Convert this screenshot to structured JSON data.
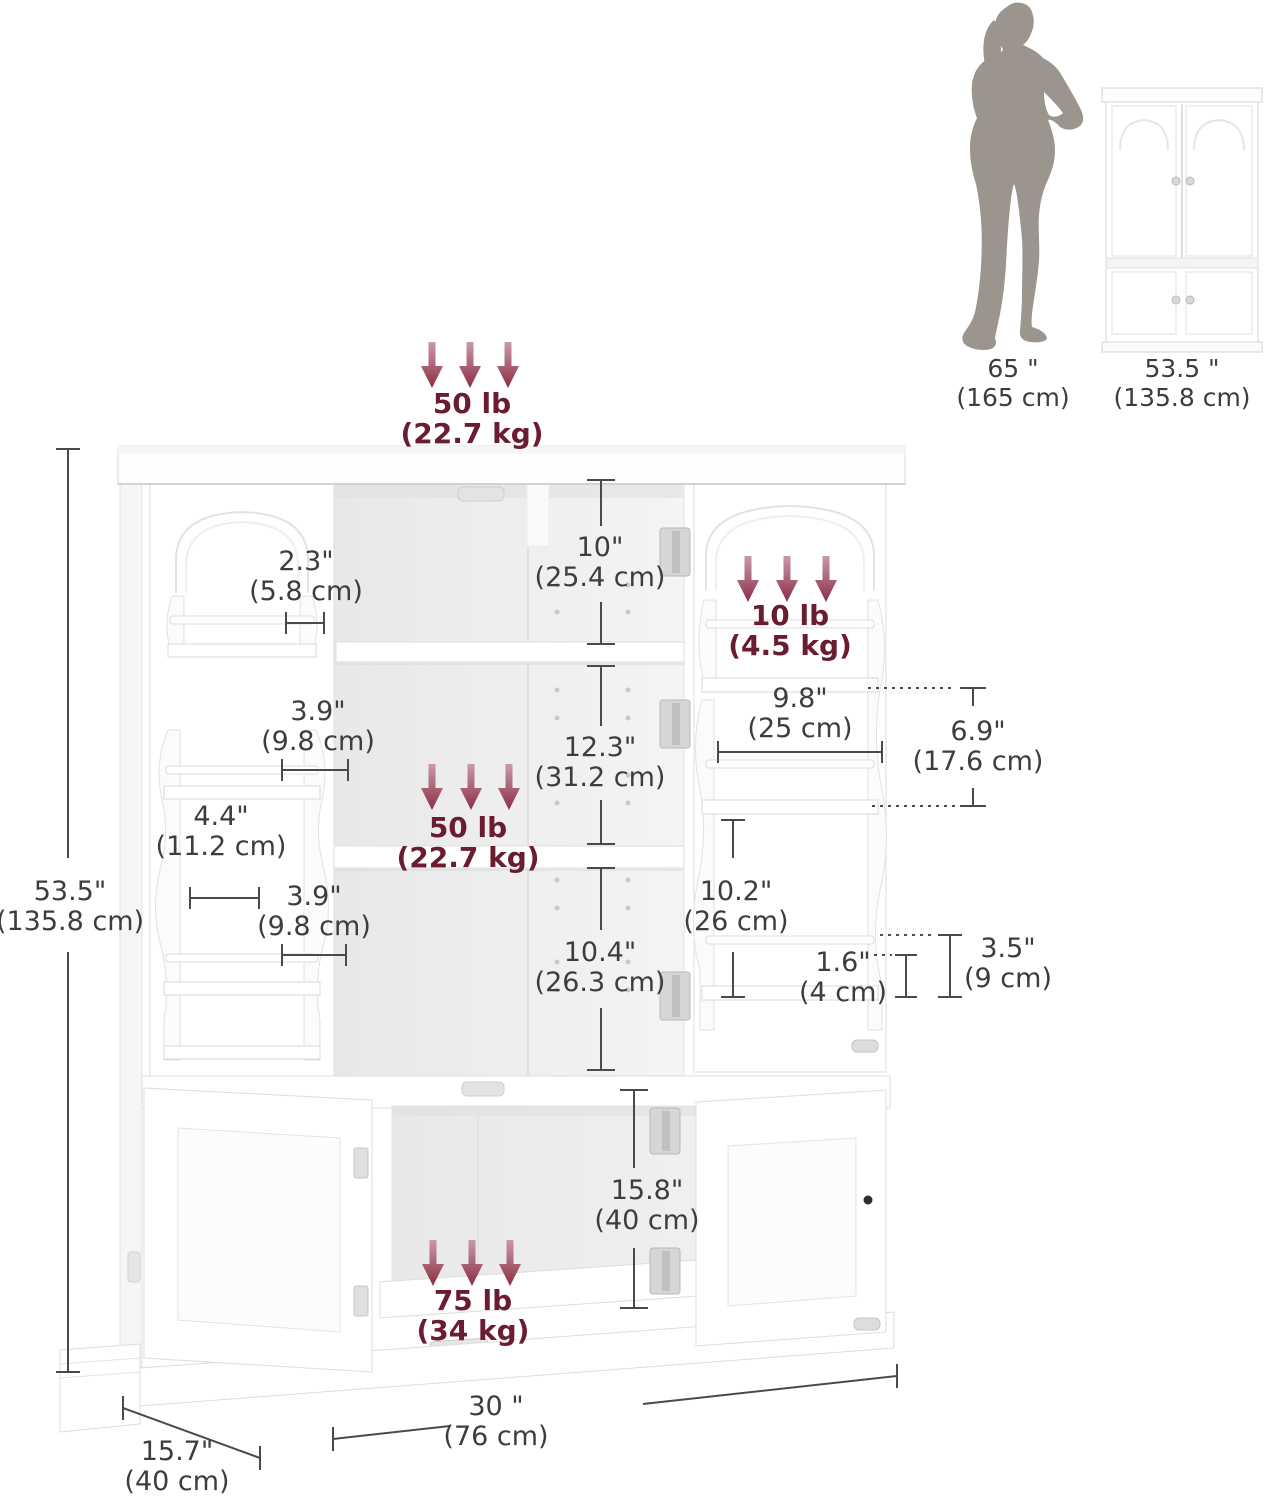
{
  "comparison": {
    "person": {
      "value": "65 \"",
      "metric": "(165 cm)"
    },
    "cabinet": {
      "value": "53.5 \"",
      "metric": "(135.8 cm)"
    }
  },
  "weight_capacities": {
    "top_panel": {
      "value": "50 lb",
      "metric": "(22.7 kg)"
    },
    "door_rack": {
      "value": "10 lb",
      "metric": "(4.5 kg)"
    },
    "middle_shelf": {
      "value": "50 lb",
      "metric": "(22.7 kg)"
    },
    "bottom_compartment": {
      "value": "75 lb",
      "metric": "(34 kg)"
    }
  },
  "dimensions": {
    "overall_height": {
      "value": "53.5\"",
      "metric": "(135.8 cm)"
    },
    "left_rack_top_depth": {
      "value": "2.3\"",
      "metric": "(5.8 cm)"
    },
    "left_rack_upper_gap": {
      "value": "3.9\"",
      "metric": "(9.8 cm)"
    },
    "left_door_side_depth": {
      "value": "4.4\"",
      "metric": "(11.2 cm)"
    },
    "left_rack_lower_gap": {
      "value": "3.9\"",
      "metric": "(9.8 cm)"
    },
    "top_compartment_height": {
      "value": "10\"",
      "metric": "(25.4 cm)"
    },
    "middle_compartment_height": {
      "value": "12.3\"",
      "metric": "(31.2 cm)"
    },
    "lower_compartment_height": {
      "value": "10.4\"",
      "metric": "(26.3 cm)"
    },
    "right_rack_width": {
      "value": "9.8\"",
      "metric": "(25 cm)"
    },
    "right_rack_gap_upper": {
      "value": "6.9\"",
      "metric": "(17.6 cm)"
    },
    "right_rack_gap_lower": {
      "value": "10.2\"",
      "metric": "(26 cm)"
    },
    "rack_lip_height": {
      "value": "1.6\"",
      "metric": "(4 cm)"
    },
    "rack_shelf_height": {
      "value": "3.5\"",
      "metric": "(9 cm)"
    },
    "bottom_compartment_height": {
      "value": "15.8\"",
      "metric": "(40 cm)"
    },
    "overall_width": {
      "value": "30 \"",
      "metric": "(76 cm)"
    },
    "overall_depth": {
      "value": "15.7\"",
      "metric": "(40 cm)"
    }
  },
  "icons": {
    "weight_arrow": "↓",
    "person_silhouette": "standing-woman",
    "cabinet_thumbnail": "closed-4-door-cabinet"
  },
  "colors": {
    "background": "#ffffff",
    "dimension_text": "#3d3d3d",
    "dimension_line": "#4a4a4a",
    "weight_text": "#6b1d30",
    "arrow_gradient_top": "#c99aa7",
    "arrow_gradient_bottom": "#8d2d45",
    "cabinet_outline": "#dcdcdc",
    "interior_fill": "#ededed",
    "silhouette_gray": "#9b958d"
  }
}
